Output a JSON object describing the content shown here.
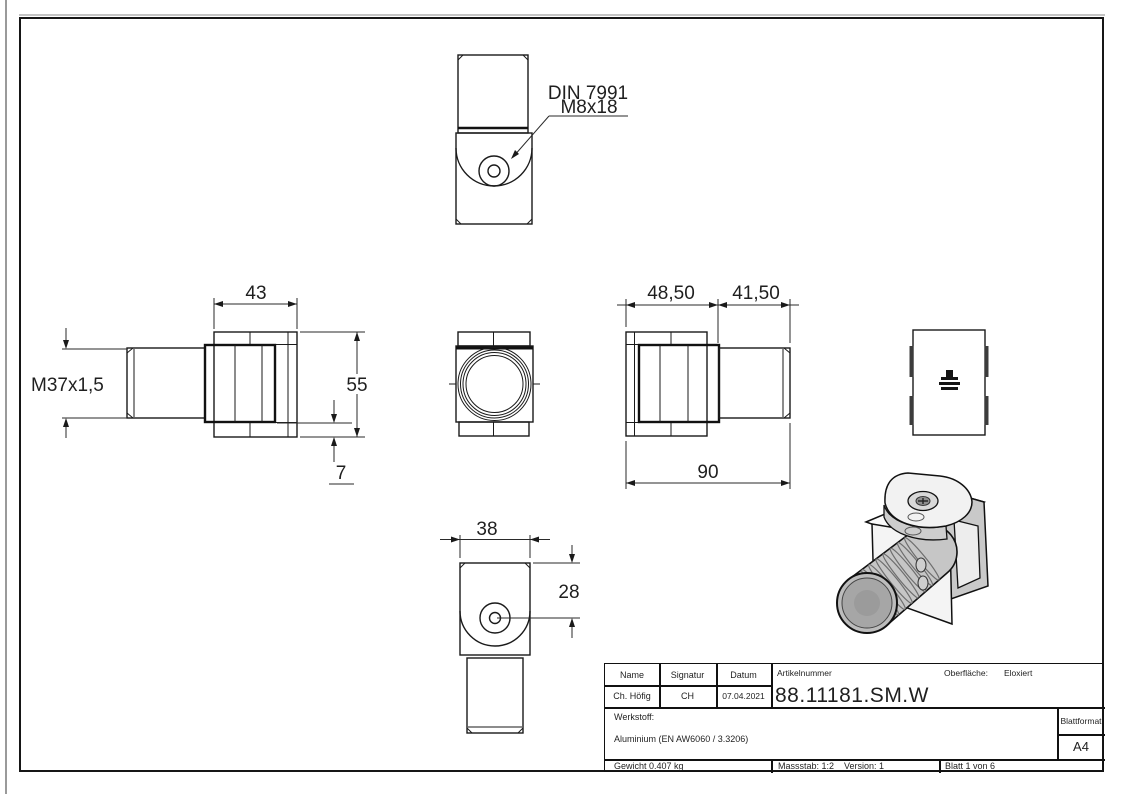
{
  "drawing": {
    "leader_note": {
      "line1": "DIN 7991",
      "line2": "M8x18"
    },
    "thread_label": "M37x1,5",
    "dims": {
      "body_width": "43",
      "body_height": "55",
      "offset_step": "7",
      "segment_left": "48,50",
      "segment_right": "41,50",
      "total_length": "90",
      "slot_width": "38",
      "hole_center": "28"
    }
  },
  "title_block": {
    "name_header": "Name",
    "signature_header": "Signatur",
    "date_header": "Datum",
    "article_header": "Artikelnummer",
    "surface_label": "Oberfläche:",
    "surface_value": "Eloxiert",
    "name_value": "Ch. Höfig",
    "signature_value": "CH",
    "date_value": "07.04.2021",
    "article_number": "88.11181.SM.W",
    "material_label": "Werkstoff:",
    "material_value": "Aluminium (EN AW6060 / 3.3206)",
    "format_label": "Blattformat",
    "format_value": "A4",
    "weight": "Gewicht 0.407 kg",
    "scale": "Massstab: 1:2",
    "version": "Version: 1",
    "sheet": "Blatt 1 von 6"
  },
  "colors": {
    "line": "#1a1a1a",
    "iso_body": "#c6c6c6",
    "iso_face": "#a8a8a8",
    "iso_light": "#f4f4f4"
  }
}
